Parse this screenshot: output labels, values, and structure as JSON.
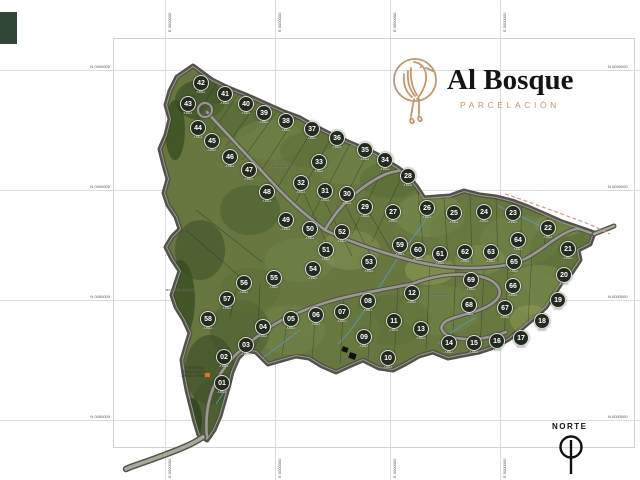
{
  "logo": {
    "title": "Al Bosque",
    "subtitle": "PARCELACIÓN",
    "accent": "#c5956b"
  },
  "compass": {
    "label": "NORTE"
  },
  "grid": {
    "h_lines_y": [
      70,
      190,
      300,
      420
    ],
    "v_lines_x": [
      165,
      275,
      390,
      500
    ],
    "h_label": "N 0000000",
    "v_label": "E 0000000"
  },
  "map": {
    "area_label": "AREA",
    "gate_note": [
      "PORTERIA +",
      "ZONA COMUN",
      "AREA: 1.900M²"
    ],
    "labels": [
      {
        "text": "NACIMIENTO",
        "x": 272,
        "y": 164
      },
      {
        "text": "BOSQUE NATIVO",
        "x": 166,
        "y": 288
      },
      {
        "text": "NACIMIENTO",
        "x": 428,
        "y": 292
      }
    ],
    "colors": {
      "terrain_base": "#67773f",
      "road": "#9a9a8e",
      "road_edge": "#53534a",
      "stream": "#5a9bd0",
      "boundary_dashed": "#e09090",
      "lot_circle": "#232a20"
    },
    "lots": [
      {
        "n": "01",
        "x": 222,
        "y": 383
      },
      {
        "n": "02",
        "x": 224,
        "y": 357
      },
      {
        "n": "03",
        "x": 246,
        "y": 345
      },
      {
        "n": "04",
        "x": 263,
        "y": 327
      },
      {
        "n": "05",
        "x": 291,
        "y": 319
      },
      {
        "n": "06",
        "x": 316,
        "y": 315
      },
      {
        "n": "07",
        "x": 342,
        "y": 312
      },
      {
        "n": "08",
        "x": 368,
        "y": 301
      },
      {
        "n": "09",
        "x": 364,
        "y": 337
      },
      {
        "n": "10",
        "x": 388,
        "y": 358
      },
      {
        "n": "11",
        "x": 394,
        "y": 321
      },
      {
        "n": "12",
        "x": 412,
        "y": 293
      },
      {
        "n": "13",
        "x": 421,
        "y": 329
      },
      {
        "n": "14",
        "x": 449,
        "y": 343
      },
      {
        "n": "15",
        "x": 474,
        "y": 343
      },
      {
        "n": "16",
        "x": 497,
        "y": 341
      },
      {
        "n": "17",
        "x": 521,
        "y": 338
      },
      {
        "n": "18",
        "x": 542,
        "y": 321
      },
      {
        "n": "19",
        "x": 558,
        "y": 300
      },
      {
        "n": "20",
        "x": 564,
        "y": 275
      },
      {
        "n": "21",
        "x": 568,
        "y": 249
      },
      {
        "n": "22",
        "x": 548,
        "y": 228
      },
      {
        "n": "23",
        "x": 513,
        "y": 213
      },
      {
        "n": "24",
        "x": 484,
        "y": 212
      },
      {
        "n": "25",
        "x": 454,
        "y": 213
      },
      {
        "n": "26",
        "x": 427,
        "y": 208
      },
      {
        "n": "27",
        "x": 393,
        "y": 212
      },
      {
        "n": "28",
        "x": 408,
        "y": 176
      },
      {
        "n": "29",
        "x": 365,
        "y": 207
      },
      {
        "n": "30",
        "x": 347,
        "y": 194
      },
      {
        "n": "31",
        "x": 325,
        "y": 191
      },
      {
        "n": "32",
        "x": 301,
        "y": 183
      },
      {
        "n": "33",
        "x": 319,
        "y": 162
      },
      {
        "n": "34",
        "x": 385,
        "y": 160
      },
      {
        "n": "35",
        "x": 365,
        "y": 150
      },
      {
        "n": "36",
        "x": 337,
        "y": 138
      },
      {
        "n": "37",
        "x": 312,
        "y": 129
      },
      {
        "n": "38",
        "x": 286,
        "y": 121
      },
      {
        "n": "39",
        "x": 264,
        "y": 113
      },
      {
        "n": "40",
        "x": 246,
        "y": 104
      },
      {
        "n": "41",
        "x": 225,
        "y": 94
      },
      {
        "n": "42",
        "x": 201,
        "y": 83
      },
      {
        "n": "43",
        "x": 188,
        "y": 104
      },
      {
        "n": "44",
        "x": 198,
        "y": 128
      },
      {
        "n": "45",
        "x": 212,
        "y": 141
      },
      {
        "n": "46",
        "x": 230,
        "y": 157
      },
      {
        "n": "47",
        "x": 249,
        "y": 170
      },
      {
        "n": "48",
        "x": 267,
        "y": 192
      },
      {
        "n": "49",
        "x": 286,
        "y": 220
      },
      {
        "n": "50",
        "x": 310,
        "y": 229
      },
      {
        "n": "51",
        "x": 326,
        "y": 250
      },
      {
        "n": "52",
        "x": 342,
        "y": 232
      },
      {
        "n": "53",
        "x": 369,
        "y": 262
      },
      {
        "n": "54",
        "x": 313,
        "y": 269
      },
      {
        "n": "55",
        "x": 274,
        "y": 278
      },
      {
        "n": "56",
        "x": 244,
        "y": 283
      },
      {
        "n": "57",
        "x": 227,
        "y": 299
      },
      {
        "n": "58",
        "x": 208,
        "y": 319
      },
      {
        "n": "59",
        "x": 400,
        "y": 245
      },
      {
        "n": "60",
        "x": 418,
        "y": 250
      },
      {
        "n": "61",
        "x": 440,
        "y": 254
      },
      {
        "n": "62",
        "x": 465,
        "y": 252
      },
      {
        "n": "63",
        "x": 491,
        "y": 252
      },
      {
        "n": "64",
        "x": 518,
        "y": 240
      },
      {
        "n": "65",
        "x": 514,
        "y": 262
      },
      {
        "n": "66",
        "x": 513,
        "y": 286
      },
      {
        "n": "67",
        "x": 505,
        "y": 308
      },
      {
        "n": "68",
        "x": 469,
        "y": 305
      },
      {
        "n": "69",
        "x": 471,
        "y": 280
      }
    ]
  }
}
